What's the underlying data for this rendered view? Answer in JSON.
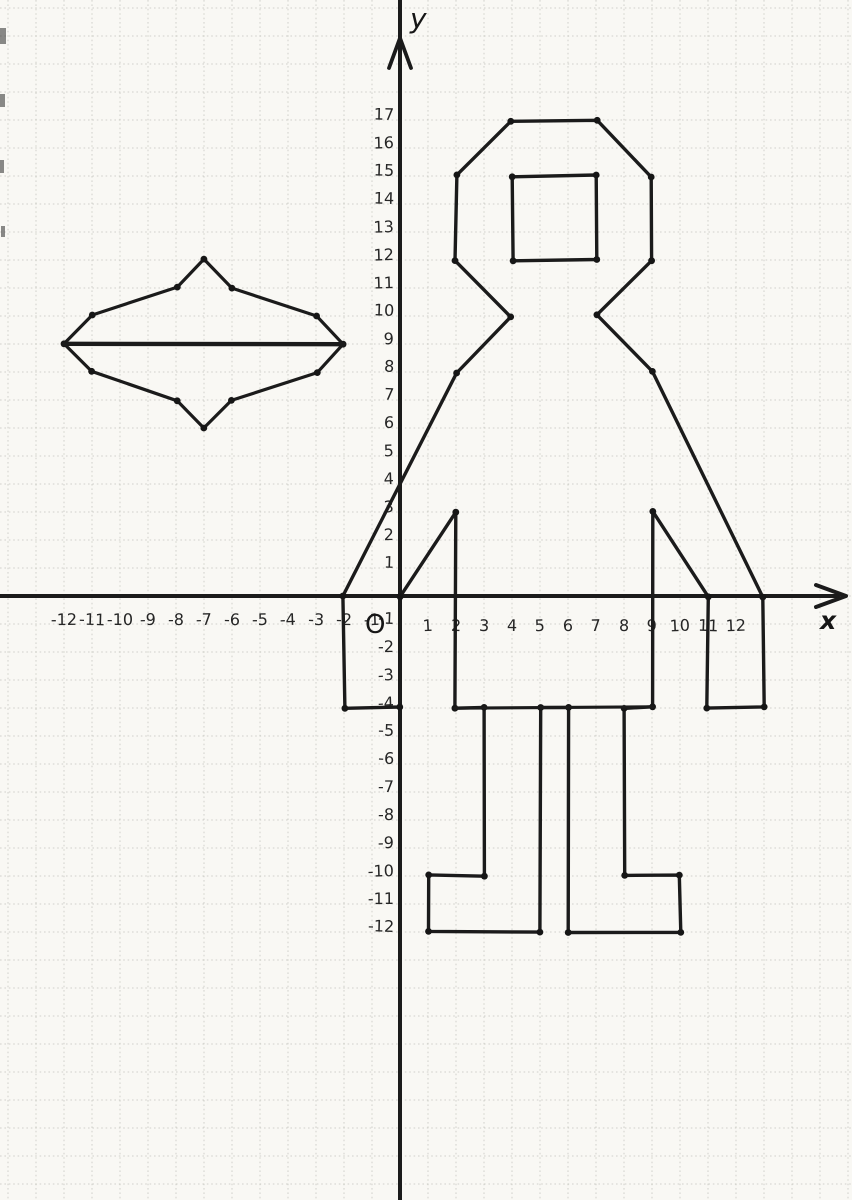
{
  "axes": {
    "x_label": "x",
    "y_label": "y",
    "origin_label": "O",
    "x_ticks": [
      -12,
      -11,
      -10,
      -9,
      -8,
      -7,
      -6,
      -5,
      -4,
      -3,
      -2,
      -1,
      1,
      2,
      3,
      4,
      5,
      6,
      7,
      8,
      9,
      10,
      11,
      12
    ],
    "y_ticks": [
      17,
      16,
      15,
      14,
      13,
      12,
      11,
      10,
      9,
      8,
      7,
      6,
      5,
      4,
      3,
      2,
      1,
      -1,
      -2,
      -3,
      -4,
      -5,
      -6,
      -7,
      -8,
      -9,
      -10,
      -11,
      -12
    ],
    "grid": "1-unit squares, dotted light gray",
    "ink_color": "#1b1b1b",
    "paper_color": "#f9f8f4"
  },
  "chart_data": {
    "type": "line",
    "title": "",
    "description": "Hand-drawn connect-the-dots coordinate picture on squared paper: a robot figure on the right side of the y-axis and a flying-saucer shape in the second quadrant",
    "x_range": [
      -12,
      13
    ],
    "y_range": [
      -12,
      17
    ],
    "grid": true,
    "series": [
      {
        "name": "robot-outline",
        "closed": true,
        "dots": true,
        "stroke_width": 3.4,
        "points": [
          [
            4,
            10
          ],
          [
            2,
            12
          ],
          [
            2,
            15
          ],
          [
            4,
            17
          ],
          [
            7,
            17
          ],
          [
            9,
            15
          ],
          [
            9,
            12
          ],
          [
            7,
            10
          ],
          [
            9,
            8
          ],
          [
            13,
            0
          ],
          [
            13,
            -4
          ],
          [
            11,
            -4
          ],
          [
            11,
            0
          ],
          [
            9,
            3
          ],
          [
            9,
            -4
          ],
          [
            8,
            -4
          ],
          [
            8,
            -10
          ],
          [
            10,
            -10
          ],
          [
            10,
            -12
          ],
          [
            6,
            -12
          ],
          [
            6,
            -4
          ],
          [
            5,
            -4
          ],
          [
            5,
            -12
          ],
          [
            1,
            -12
          ],
          [
            1,
            -10
          ],
          [
            3,
            -10
          ],
          [
            3,
            -4
          ],
          [
            2,
            -4
          ],
          [
            2,
            3
          ],
          [
            0,
            0
          ],
          [
            0,
            -4
          ],
          [
            -2,
            -4
          ],
          [
            -2,
            0
          ],
          [
            2,
            8
          ]
        ]
      },
      {
        "name": "robot-waist-line",
        "closed": false,
        "dots": false,
        "stroke_width": 3.2,
        "points": [
          [
            2,
            -4
          ],
          [
            9,
            -4
          ]
        ]
      },
      {
        "name": "robot-face-panel",
        "closed": true,
        "dots": true,
        "stroke_width": 3.4,
        "points": [
          [
            4,
            12
          ],
          [
            7,
            12
          ],
          [
            7,
            15
          ],
          [
            4,
            15
          ]
        ]
      },
      {
        "name": "saucer-outline",
        "closed": true,
        "dots": true,
        "stroke_width": 3.2,
        "points": [
          [
            -12,
            9
          ],
          [
            -11,
            10
          ],
          [
            -8,
            11
          ],
          [
            -7,
            12
          ],
          [
            -6,
            11
          ],
          [
            -3,
            10
          ],
          [
            -2,
            9
          ],
          [
            -3,
            8
          ],
          [
            -6,
            7
          ],
          [
            -7,
            6
          ],
          [
            -8,
            7
          ],
          [
            -11,
            8
          ]
        ]
      },
      {
        "name": "saucer-midline",
        "closed": false,
        "dots": false,
        "stroke_width": 4.4,
        "points": [
          [
            -12,
            9
          ],
          [
            -2,
            9
          ]
        ]
      }
    ]
  }
}
